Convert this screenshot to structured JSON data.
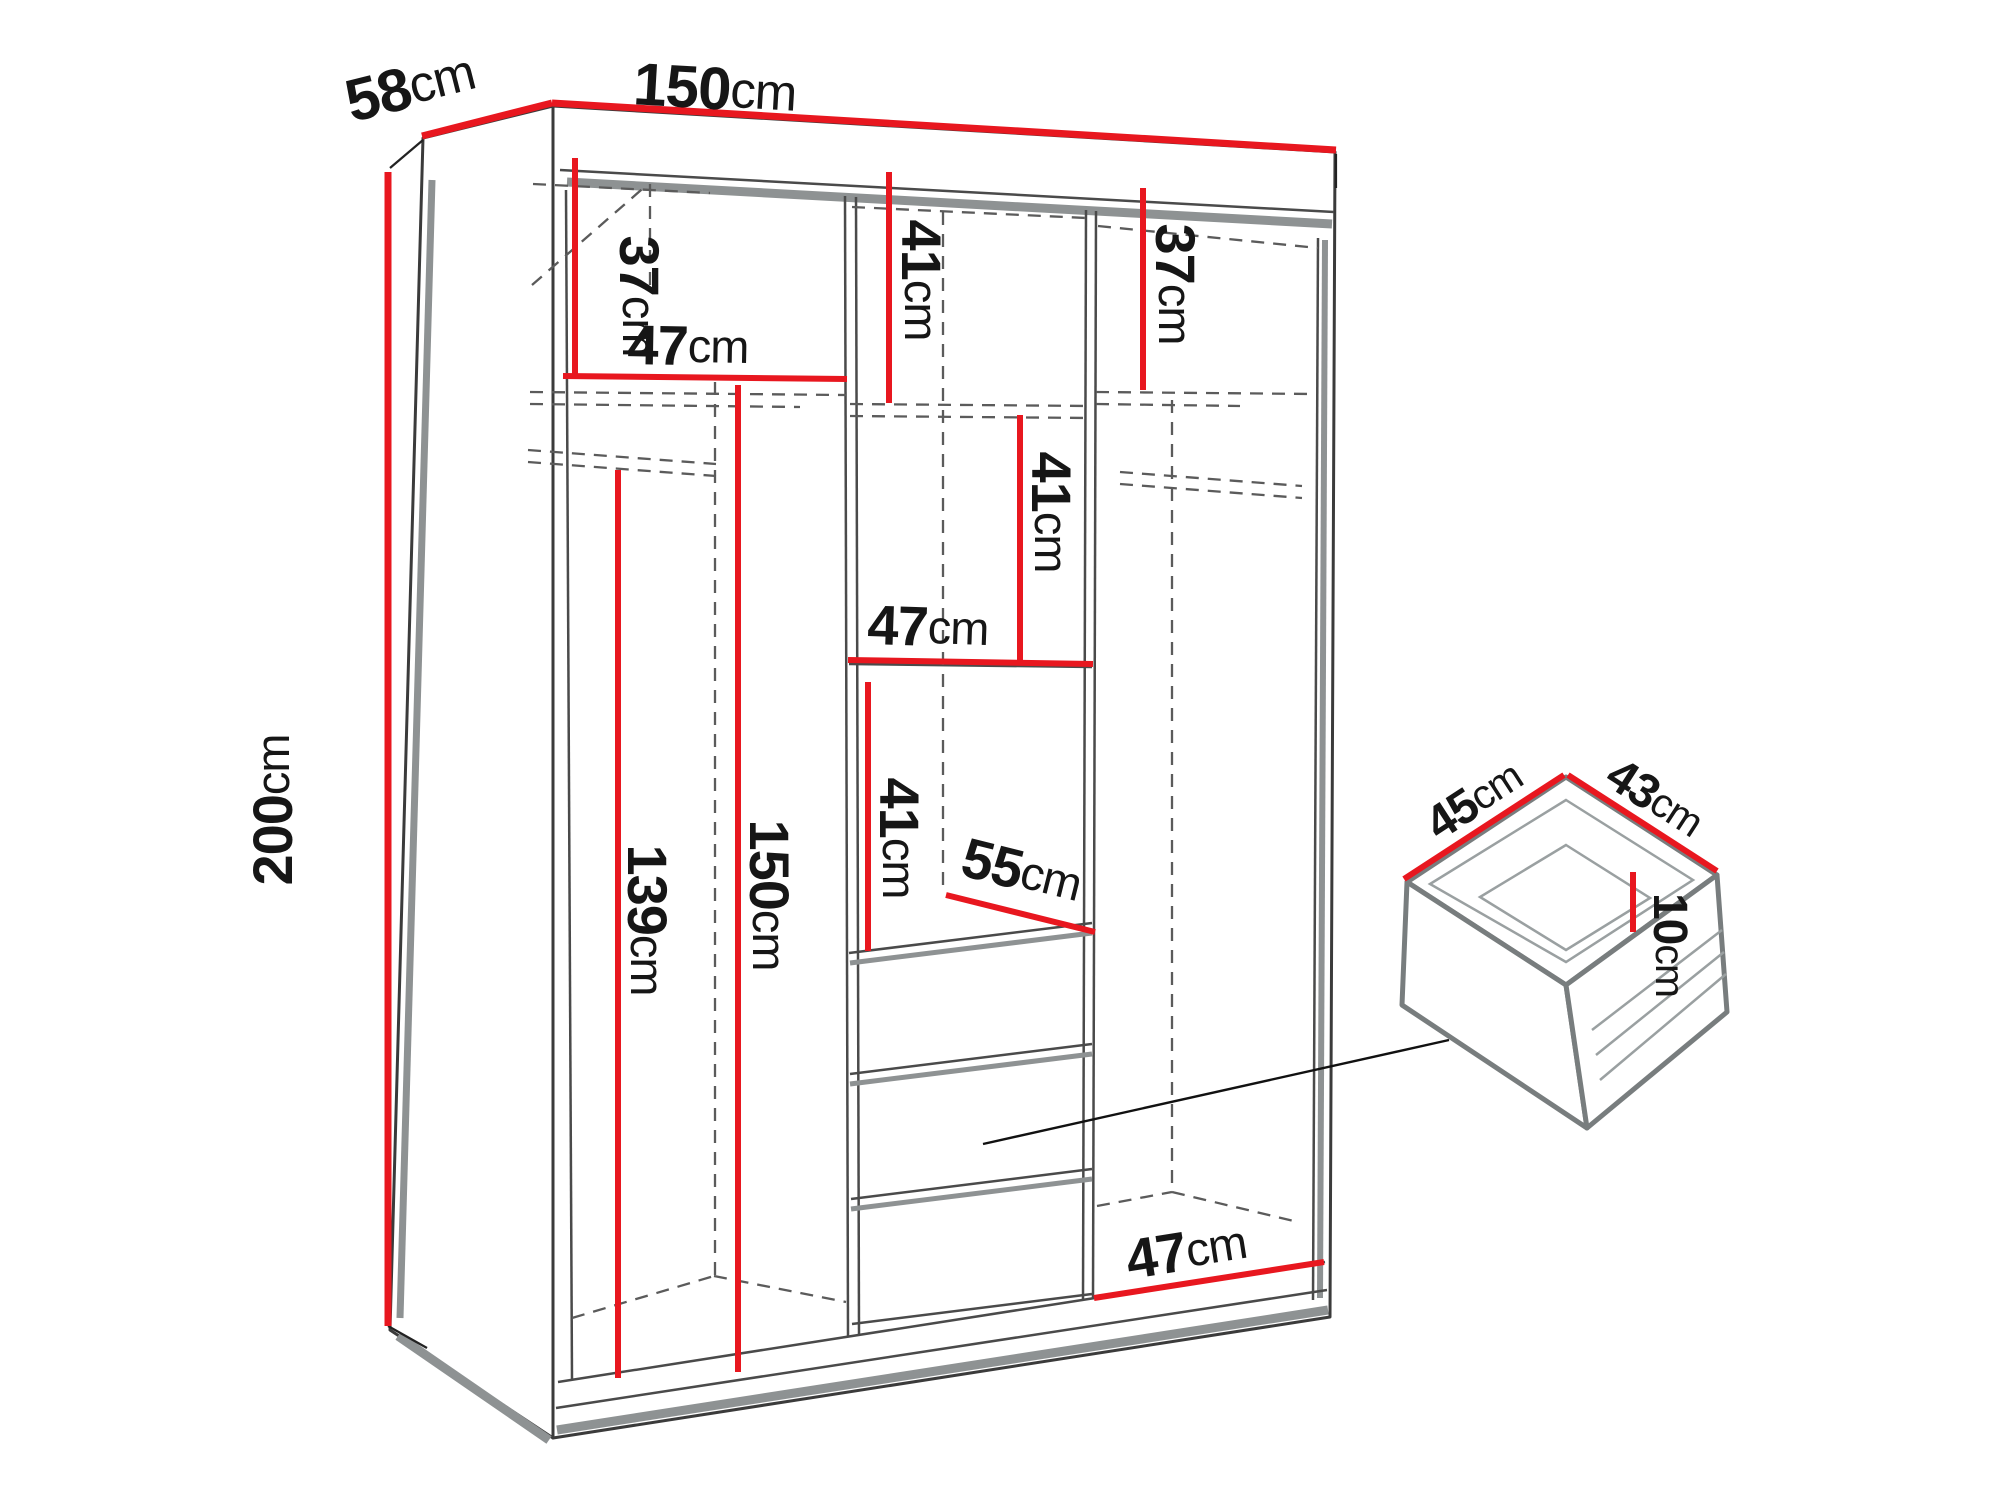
{
  "wardrobe": {
    "width": {
      "value": "150",
      "unit": "cm"
    },
    "depth": {
      "value": "58",
      "unit": "cm"
    },
    "height": {
      "value": "200",
      "unit": "cm"
    },
    "sections": {
      "left": {
        "top_shelf_height": {
          "value": "37",
          "unit": "cm"
        },
        "shelf_width": {
          "value": "47",
          "unit": "cm"
        },
        "hanging_height": {
          "value": "139",
          "unit": "cm"
        },
        "interior_height": {
          "value": "150",
          "unit": "cm"
        }
      },
      "middle": {
        "top_shelf_height": {
          "value": "41",
          "unit": "cm"
        },
        "upper_shelf_spacing": {
          "value": "41",
          "unit": "cm"
        },
        "shelf_width": {
          "value": "47",
          "unit": "cm"
        },
        "lower_shelf_spacing": {
          "value": "41",
          "unit": "cm"
        },
        "compartment_depth": {
          "value": "55",
          "unit": "cm"
        }
      },
      "right": {
        "top_shelf_height": {
          "value": "37",
          "unit": "cm"
        },
        "bottom_width": {
          "value": "47",
          "unit": "cm"
        }
      }
    }
  },
  "drawer": {
    "width": {
      "value": "45",
      "unit": "cm"
    },
    "depth": {
      "value": "43",
      "unit": "cm"
    },
    "height": {
      "value": "10",
      "unit": "cm"
    }
  },
  "colors": {
    "dimension_red": "#e8171f",
    "outline_dark": "#3b3b3b",
    "panel_gray": "#8e9293",
    "text": "#161616"
  }
}
